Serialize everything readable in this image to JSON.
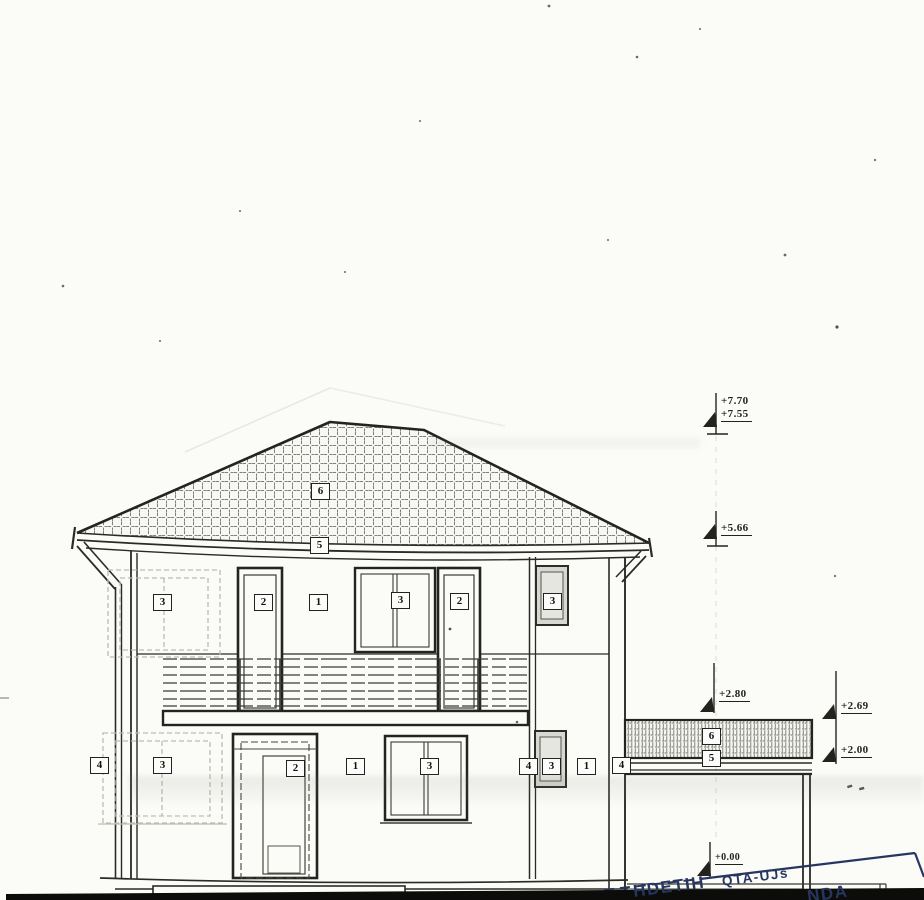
{
  "sheet": {
    "kind": "scanned front elevation drawing of a two-storey house",
    "paper_color": "#fbfbf8",
    "ink_color": "#2b2b28",
    "shade_color": "#d8d8d3",
    "stamp_color": "#26365f"
  },
  "tags": {
    "roof": "6",
    "eave": "5",
    "upper_window_left": "3",
    "upper_door_left": "2",
    "upper_wall": "1",
    "upper_window_mid": "3",
    "upper_door_right": "2",
    "upper_window_right": "3",
    "ground_downpipe_left": "4",
    "ground_window_left": "3",
    "ground_door": "2",
    "ground_wall": "1",
    "ground_window_mid": "3",
    "ground_downpipe_mid": "4",
    "ground_window_right": "3",
    "ground_wall_right": "1",
    "ground_downpipe_right": "4",
    "canopy_roof": "6",
    "canopy_eave": "5"
  },
  "elevations": {
    "ridge_top": "+7.70",
    "ridge": "+7.55",
    "eave": "+5.66",
    "canopy_top": "+2.80",
    "canopy_slab": "+2.69",
    "canopy_soffit": "+2.00",
    "ground": "+0.00"
  },
  "stamp": {
    "word_left": "HDETIH",
    "word_mid": "QTA-UJs",
    "word_right": "NDA"
  }
}
